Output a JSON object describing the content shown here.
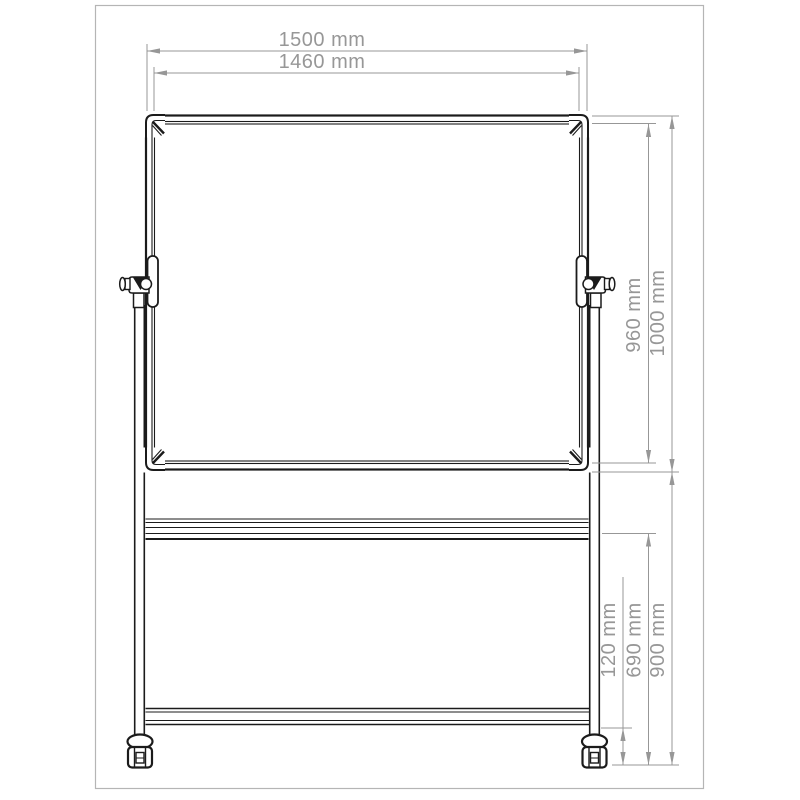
{
  "page": {
    "background": "#ffffff",
    "border_color": "#b5b5b5"
  },
  "drawing": {
    "type": "technical-dimension-drawing",
    "subject": "mobile-whiteboard-front-view",
    "object_color": "#1b1b1b",
    "dimension_color": "#979797",
    "dimensions": {
      "overall_width": "1500 mm",
      "inner_width": "1460 mm",
      "board_inner_height": "960 mm",
      "board_overall_height": "1000 mm",
      "caster_clearance": "120 mm",
      "rail_height": "690 mm",
      "stand_height": "900 mm"
    }
  }
}
